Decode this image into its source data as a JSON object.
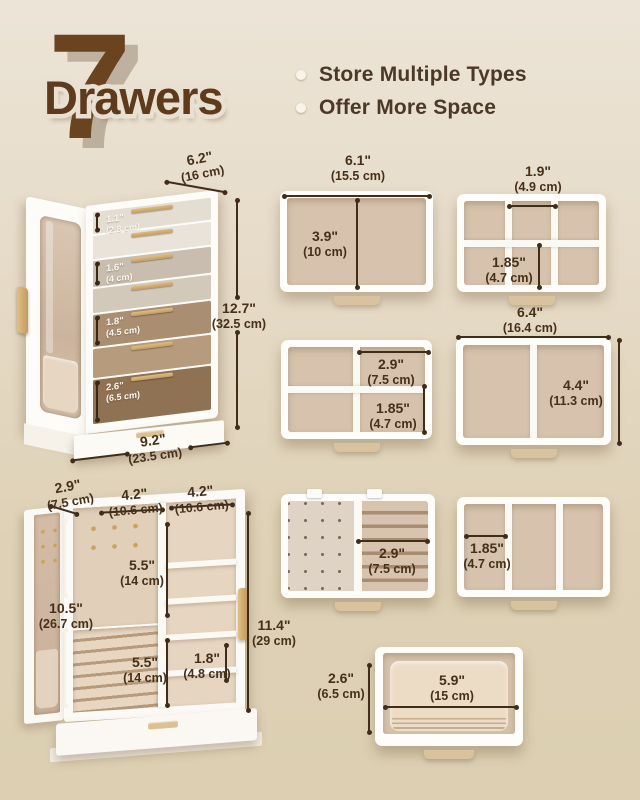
{
  "header": {
    "count": "7",
    "word": "Drawers",
    "bullets": [
      "Store Multiple Types",
      "Offer More Space"
    ]
  },
  "colors": {
    "background_top": "#ece4d7",
    "background_bottom": "#dccfb2",
    "brand_brown": "#6a431f",
    "dimension_text": "#46301a",
    "tray_lining": "#d7c3ad",
    "handle_gold": "#c9a25d"
  },
  "box1": {
    "depth": {
      "in": "6.2\"",
      "cm": "(16 cm)"
    },
    "height": {
      "in": "12.7\"",
      "cm": "(32.5 cm)"
    },
    "width": {
      "in": "9.2\"",
      "cm": "(23.5 cm)"
    },
    "drawers": [
      {
        "in": "1.1\"",
        "cm": "(2.8 cm)",
        "color": "#e4ddd2"
      },
      {
        "in": "",
        "cm": "",
        "color": "#e9e3d9"
      },
      {
        "in": "1.6\"",
        "cm": "(4 cm)",
        "color": "#c8bdaf"
      },
      {
        "in": "",
        "cm": "",
        "color": "#d3c9bb"
      },
      {
        "in": "1.8\"",
        "cm": "(4.5 cm)",
        "color": "#a98e71"
      },
      {
        "in": "",
        "cm": "",
        "color": "#b69b7d"
      },
      {
        "in": "2.6\"",
        "cm": "(6.5 cm)",
        "color": "#8f7254"
      }
    ]
  },
  "trays": {
    "open": {
      "width": {
        "in": "6.1\"",
        "cm": "(15.5 cm)"
      },
      "depth": {
        "in": "3.9\"",
        "cm": "(10 cm)"
      }
    },
    "six": {
      "cell_w": {
        "in": "1.9\"",
        "cm": "(4.9 cm)"
      },
      "cell_h": {
        "in": "1.85\"",
        "cm": "(4.7 cm)"
      }
    },
    "four": {
      "cell_w": {
        "in": "2.9\"",
        "cm": "(7.5 cm)"
      },
      "cell_h": {
        "in": "1.85\"",
        "cm": "(4.7 cm)"
      }
    },
    "two": {
      "width": {
        "in": "6.4\"",
        "cm": "(16.4 cm)"
      },
      "depth": {
        "in": "4.4\"",
        "cm": "(11.3 cm)"
      }
    },
    "earring": {
      "roll_w": {
        "in": "2.9\"",
        "cm": "(7.5 cm)"
      }
    },
    "three": {
      "cell_w": {
        "in": "1.85\"",
        "cm": "(4.7 cm)"
      }
    },
    "deep": {
      "height": {
        "in": "2.6\"",
        "cm": "(6.5 cm)"
      },
      "width": {
        "in": "5.9\"",
        "cm": "(15 cm)"
      }
    }
  },
  "box2": {
    "door_depth": {
      "in": "2.9\"",
      "cm": "(7.5 cm)"
    },
    "left_width": {
      "in": "4.2\"",
      "cm": "(10.6 cm)"
    },
    "right_width": {
      "in": "4.2\"",
      "cm": "(10.6 cm)"
    },
    "hang_height": {
      "in": "5.5\"",
      "cm": "(14 cm)"
    },
    "interior_height": {
      "in": "10.5\"",
      "cm": "(26.7 cm)"
    },
    "roll_height": {
      "in": "5.5\"",
      "cm": "(14 cm)"
    },
    "shelf_gap": {
      "in": "1.8\"",
      "cm": "(4.8 cm)"
    },
    "total_height": {
      "in": "11.4\"",
      "cm": "(29 cm)"
    }
  }
}
